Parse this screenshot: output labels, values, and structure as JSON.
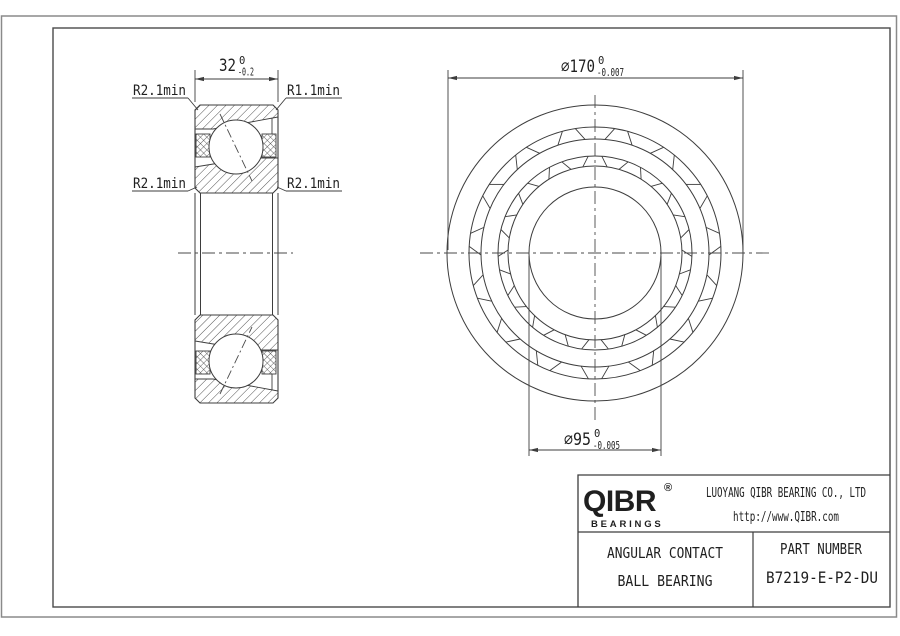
{
  "drawing": {
    "dim_width": {
      "value": "32",
      "tol_top": "0",
      "tol_bottom": "-0.2"
    },
    "dim_outer_diameter": {
      "value": "∅170",
      "tol_top": "0",
      "tol_bottom": "-0.007"
    },
    "dim_bore_diameter": {
      "value": "∅95",
      "tol_top": "0",
      "tol_bottom": "-0.005"
    },
    "radius_labels": {
      "top_left": "R2.1min",
      "top_right": "R1.1min",
      "mid_left": "R2.1min",
      "mid_right": "R2.1min"
    }
  },
  "title_block": {
    "logo_text": "QIBR",
    "logo_mark": "®",
    "logo_subtext": "BEARINGS",
    "company": "LUOYANG QIBR BEARING CO., LTD",
    "website": "http://www.QIBR.com",
    "product_line1": "ANGULAR CONTACT",
    "product_line2": "BALL BEARING",
    "part_number_label": "PART NUMBER",
    "part_number": "B7219-E-P2-DU"
  },
  "colors": {
    "line": "#3d3d3d",
    "border_gray": "#8a8a8a",
    "text": "#1f1f1f"
  }
}
